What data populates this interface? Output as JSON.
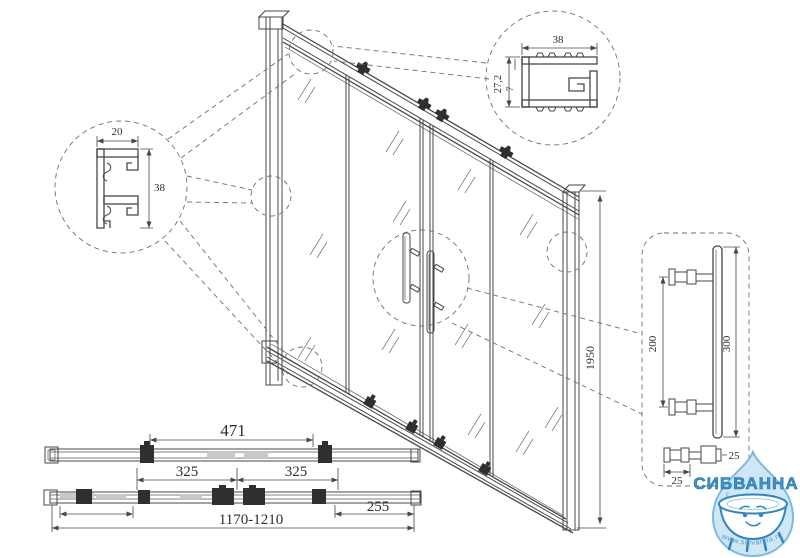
{
  "dims": {
    "wall_profile_width": "20",
    "wall_profile_depth": "38",
    "top_rail_width": "38",
    "top_rail_height": "27,2",
    "top_rail_lip": "7",
    "door_height": "1950",
    "handle_mount_spacing": "200",
    "handle_length": "300",
    "handle_bar_dia": "25",
    "handle_knob_dia": "25",
    "roller_spacing": "471",
    "door_width_left": "325",
    "door_width_right": "325",
    "end_panel_width": "255",
    "overall_width": "1170-1210"
  },
  "logo": {
    "brand": "СИБВАННА",
    "website": "www.sibvanna.ru",
    "brand_color": "#3f94ca",
    "brand_outline": "#1e6fa8",
    "drop_fill": "#cfe6f5",
    "drop_stroke": "#7fb9e0"
  },
  "drawing": {
    "line_color": "#474747",
    "background": "#ffffff"
  }
}
